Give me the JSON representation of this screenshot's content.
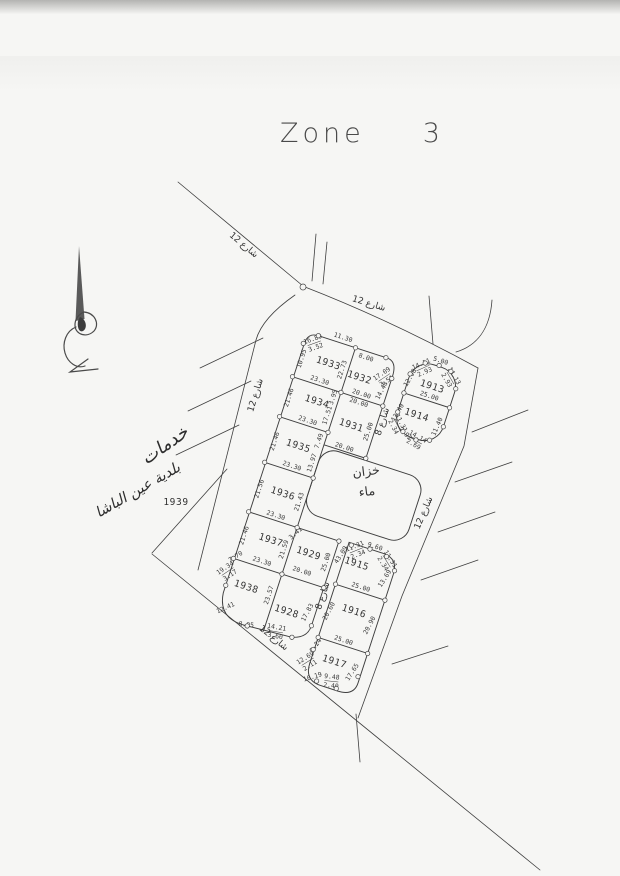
{
  "title": {
    "zone_label": "Zone",
    "zone_number": "3"
  },
  "streets": {
    "width12_label": "شارع 12",
    "width8_label": "شارع 8"
  },
  "water_tank": {
    "line1": "خزان",
    "line2": "ماء"
  },
  "annotations": {
    "handwritten_line1": "خدمات",
    "handwritten_line2": "بلدية عين الباشا"
  },
  "plots": {
    "1933": {
      "label": "1933",
      "dims": {
        "corner_nw": "16.89/3.52",
        "top": "11.30",
        "left": "10.95",
        "bottom": "23.30",
        "right": "22.73"
      }
    },
    "1932": {
      "label": "1932",
      "dims": {
        "top": "8.00",
        "corner_ne": "17.09/3.51",
        "right": "14.48",
        "bottom": "20.00"
      }
    },
    "1934": {
      "label": "1934",
      "dims": {
        "left": "21.46",
        "right": "17.51",
        "corner": "3.95",
        "bottom": "23.30"
      }
    },
    "1935": {
      "label": "1935",
      "dims": {
        "left": "21.46",
        "right_upper": "7.49",
        "right": "13.97",
        "bottom": "23.30"
      }
    },
    "1931": {
      "label": "1931",
      "dims": {
        "top": "20.00",
        "right": "25.00",
        "bottom": "20.00"
      }
    },
    "1936": {
      "label": "1936",
      "dims": {
        "left": "21.56",
        "right": "21.43",
        "bottom": "23.30"
      }
    },
    "1937": {
      "label": "1937",
      "dims": {
        "left": "21.46",
        "right": "21.59",
        "bottom": "23.30",
        "corner_sw": "7.70"
      }
    },
    "1929": {
      "label": "1929",
      "dims": {
        "corner_nw": "3.41",
        "right": "25.00",
        "bottom": "20.00"
      }
    },
    "1938": {
      "label": "1938",
      "dims": {
        "corner_nw": "19.34/3.17",
        "right": "23.57",
        "corner_sw": "12.41",
        "bottom": "8.95"
      }
    },
    "1928": {
      "label": "1928",
      "dims": {
        "bottom": "14.21/3.60",
        "right": "17.83"
      }
    },
    "1913": {
      "label": "1913",
      "dims": {
        "corner_nw": "14.11/2.93",
        "top": "5.00",
        "corner_ne": "14.13/2.93",
        "left": "12.08",
        "bottom": "25.00"
      }
    },
    "1914": {
      "label": "1914",
      "dims": {
        "left": "13.40",
        "right": "11.40",
        "corner_sw": "11.31/2.34",
        "corner_s": "7.92",
        "bottom": "14.14/2.69"
      }
    },
    "1915": {
      "label": "1915",
      "dims": {
        "left": "43.09",
        "corner_nw": "11.31/2.34",
        "top": "9.60",
        "corner_ne": "11.31/2.34",
        "right": "13.69",
        "bottom": "25.00"
      }
    },
    "1916": {
      "label": "1916",
      "dims": {
        "left": "20.60",
        "right": "20.90",
        "bottom": "25.00"
      }
    },
    "1917": {
      "label": "1917",
      "dims": {
        "left": "9.24",
        "corner_w": "12.69/2.11",
        "corner_sw": "10.19",
        "bottom": "9.48/2.40",
        "right": "17.65"
      }
    },
    "1939": {
      "label": "1939"
    }
  }
}
